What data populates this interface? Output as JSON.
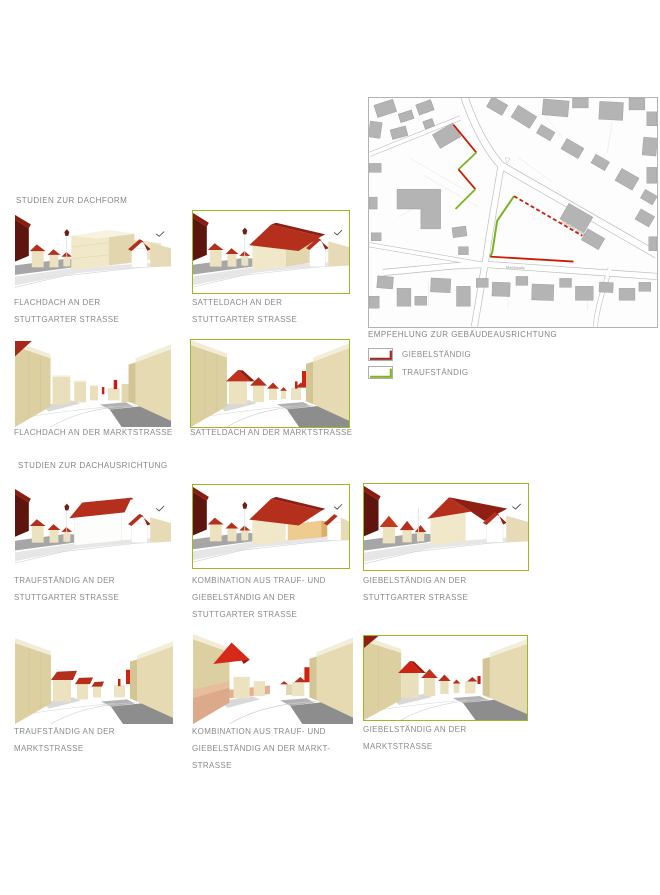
{
  "colors": {
    "accent_green": "#9cb829",
    "accent_red": "#9c2723",
    "map_green": "#7ab41e",
    "map_red": "#cb1d05",
    "text_gray": "#8a8a8a"
  },
  "sections": {
    "dachform": {
      "heading": "STUDIEN ZUR DACHFORM"
    },
    "dachausrichtung": {
      "heading": "STUDIEN ZUR DACHAUSRICHTUNG"
    }
  },
  "panels": [
    {
      "id": "flachdach-stuttgarter",
      "caption": [
        "FLACHDACH AN DER",
        "STUTTGARTER STRASSE"
      ],
      "highlighted": false
    },
    {
      "id": "satteldach-stuttgarter",
      "caption": [
        "SATTELDACH AN DER",
        "STUTTGARTER STRASSE"
      ],
      "highlighted": true
    },
    {
      "id": "flachdach-markt",
      "caption": [
        "FLACHDACH AN DER MARKTSTRASSE"
      ],
      "highlighted": false
    },
    {
      "id": "satteldach-markt",
      "caption": [
        "SATTELDACH AN DER MARKTSTRASSE"
      ],
      "highlighted": true
    },
    {
      "id": "traufstaendig-stuttgarter",
      "caption": [
        "TRAUFSTÄNDIG AN DER",
        "STUTTGARTER STRASSE"
      ],
      "highlighted": false
    },
    {
      "id": "kombination-stuttgarter",
      "caption": [
        "KOMBINATION AUS TRAUF- UND",
        "GIEBELSTÄNDIG AN DER",
        "STUTTGARTER STRASSE"
      ],
      "highlighted": true
    },
    {
      "id": "giebelstaendig-stuttgarter",
      "caption": [
        "GIEBELSTÄNDIG AN DER",
        "STUTTGARTER STRASSE"
      ],
      "highlighted": true
    },
    {
      "id": "traufstaendig-markt",
      "caption": [
        "TRAUFSTÄNDIG AN DER",
        "MARKTSTRASSE"
      ],
      "highlighted": false
    },
    {
      "id": "kombination-markt",
      "caption": [
        "KOMBINATION AUS TRAUF- UND",
        "GIEBELSTÄNDIG AN DER MARKT-",
        "STRASSE"
      ],
      "highlighted": false
    },
    {
      "id": "giebelstaendig-markt",
      "caption": [
        "GIEBELSTÄNDIG AN DER",
        "MARKTSTRASSE"
      ],
      "highlighted": true
    }
  ],
  "map": {
    "legend_title": "EMPFEHLUNG ZUR GEBÄUDEAUSRICHTUNG",
    "legend": [
      {
        "label": "GIEBELSTÄNDIG",
        "color": "#9c2723"
      },
      {
        "label": "TRAUFSTÄNDIG",
        "color": "#84b228"
      }
    ],
    "street_labels": [
      {
        "text": "Marktstraße"
      },
      {
        "text": "Stuttgarter Straße"
      }
    ]
  }
}
